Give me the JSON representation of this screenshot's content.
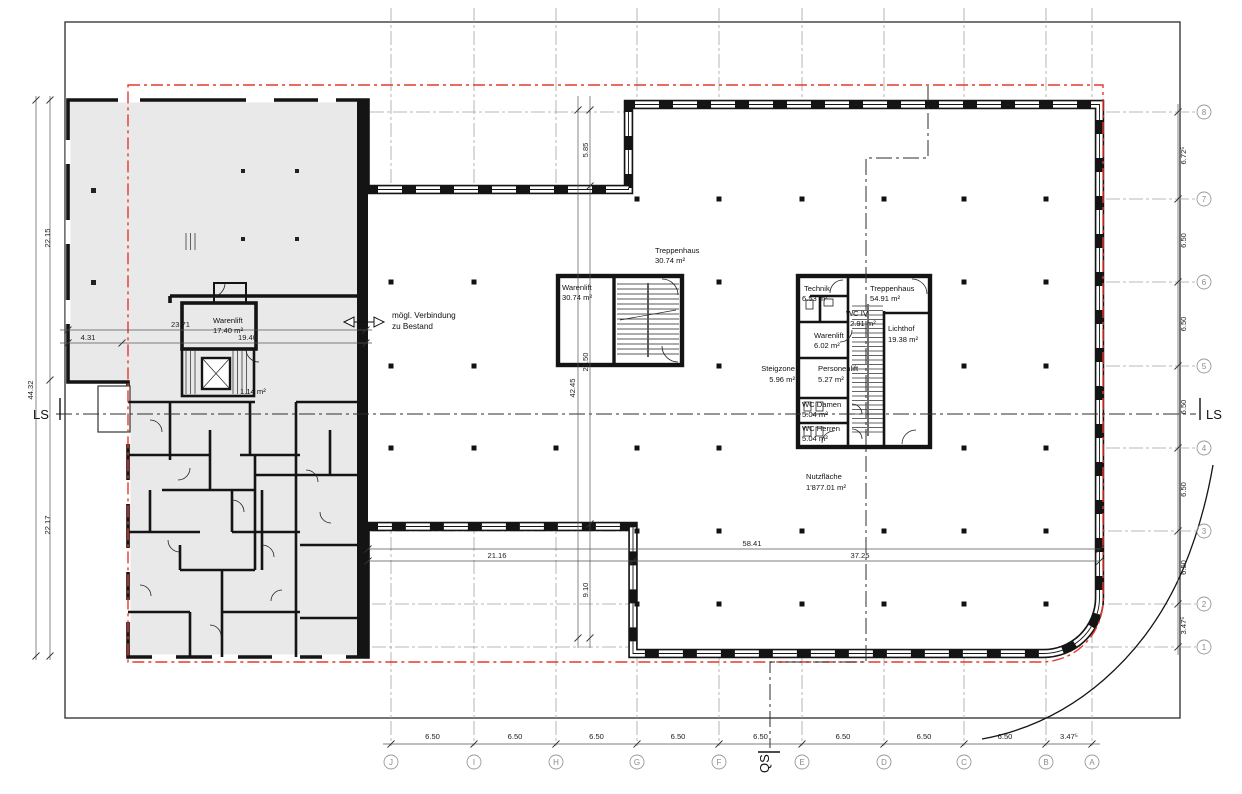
{
  "grid": {
    "columns": [
      "J",
      "I",
      "H",
      "G",
      "F",
      "E",
      "D",
      "C",
      "B",
      "A"
    ],
    "rows": [
      "8",
      "7",
      "6",
      "5",
      "4",
      "3",
      "2",
      "1"
    ],
    "bottom_dims": [
      "6.50",
      "6.50",
      "6.50",
      "6.50",
      "6.50",
      "6.50",
      "6.50",
      "6.50",
      "3.47⁵"
    ],
    "right_dims": [
      "6.72⁵",
      "6.50",
      "6.50",
      "6.50",
      "6.50",
      "6.50",
      "3.47⁵"
    ]
  },
  "sections": {
    "ls_left": "LS",
    "ls_right": "LS",
    "qs": "QS"
  },
  "rooms": {
    "treppenhaus1": {
      "name": "Treppenhaus",
      "area": "30.74 m²"
    },
    "warenlift1": {
      "name": "Warenlift",
      "area": "30.74 m²"
    },
    "technik": {
      "name": "Technik",
      "area": "6.53 m²"
    },
    "treppenhaus2": {
      "name": "Treppenhaus",
      "area": "54.91 m²"
    },
    "wc_iv": {
      "name": "WC IV",
      "area": "2.91 m²"
    },
    "warenlift2": {
      "name": "Warenlift",
      "area": "6.02 m²"
    },
    "personenlift": {
      "name": "Personenlift",
      "area": "5.27 m²"
    },
    "lichthof": {
      "name": "Lichthof",
      "area": "19.38 m²"
    },
    "steigzone": {
      "name": "Steigzone",
      "area": "5.96 m²"
    },
    "wc_damen": {
      "name": "WC Damen",
      "area": "5.04 m²"
    },
    "wc_herren": {
      "name": "WC Herren",
      "area": "5.04 m²"
    },
    "warenlift_bestand": {
      "name": "Warenlift",
      "area": "17.40 m²"
    },
    "kleinraum": {
      "area": "1.14 m²"
    },
    "nutzflaeche": {
      "name": "Nutzfläche",
      "area": "1'877.01 m²"
    }
  },
  "dims": {
    "left_top": "22.15",
    "left_total": "44.32",
    "left_bottom": "22.17",
    "w431": "4.31",
    "w2371": "23.71",
    "w1940": "19.40",
    "v585": "5.85",
    "v2750": "27.50",
    "v4245": "42.45",
    "v910": "9.10",
    "h2116": "21.16",
    "h5841": "58.41",
    "h3725": "37.25"
  },
  "annotations": {
    "verbindung_line1": "mögl. Verbindung",
    "verbindung_line2": "zu Bestand"
  },
  "colors": {
    "boundary_red": "#e8382b",
    "existing_fill": "#e9e9e9",
    "grid_gray": "#a3a3a3",
    "wall_black": "#141414"
  }
}
